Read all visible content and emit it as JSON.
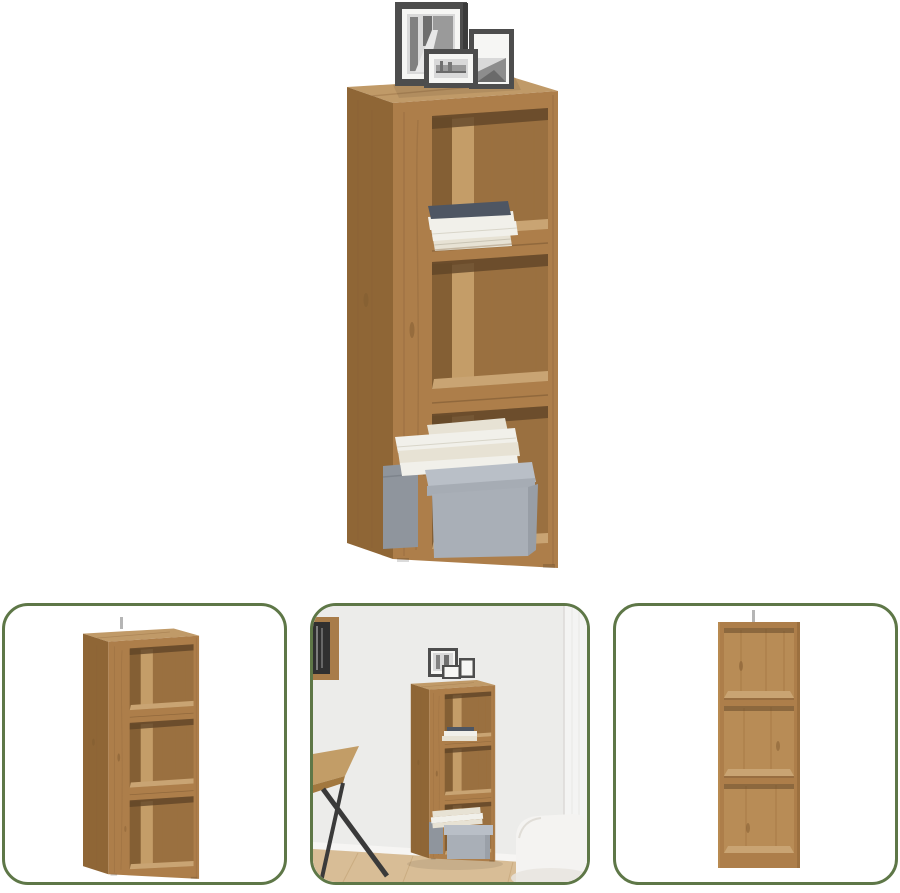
{
  "page": {
    "kind": "product-image-collage",
    "background": "#ffffff"
  },
  "main_image": {
    "alt": "Wooden corner cabinet with three open cube compartments, decorated with three picture frames on top, a stack of books on the first shelf and books with a grey storage box in the bottom compartment"
  },
  "thumbnails": [
    {
      "alt": "Corner cabinet, empty, angled view on white background"
    },
    {
      "alt": "Corner cabinet staged in a living room between a desk and a white armchair"
    },
    {
      "alt": "Corner cabinet, empty, front view on white background"
    }
  ],
  "colors": {
    "thumb_border": "#5e7747",
    "wood_front": "#ad7e4a",
    "wood_side": "#8f6636",
    "wood_top": "#c09a68",
    "wood_interior": "#9a7040",
    "wood_interior_dark": "#845f34",
    "wood_interior_light": "#c49d68",
    "wood_interior_shadow": "#5f4426",
    "wood_shelf_top": "#c9a473",
    "wood_back_panel": "#b88c56",
    "wood_edge": "#7a5731",
    "box_gray": "#a9afb7",
    "box_gray_dark": "#8f959d",
    "box_lid": "#b9bfc7",
    "book_white": "#f1f0ea",
    "book_cream": "#e7e2d4",
    "book_blue": "#4e5663",
    "frame_dark": "#4d4d4d",
    "frame_mat": "#f6f6f4",
    "photo_light": "#d9d9d9",
    "photo_dark": "#6f6f6f",
    "room_wall": "#ececea",
    "room_wall_light": "#f4f4f3",
    "room_floor": "#d8bd96",
    "sofa_white": "#f4f3f1",
    "desk_leg": "#3a3a3a",
    "metal_gray": "#b5b5b5"
  }
}
